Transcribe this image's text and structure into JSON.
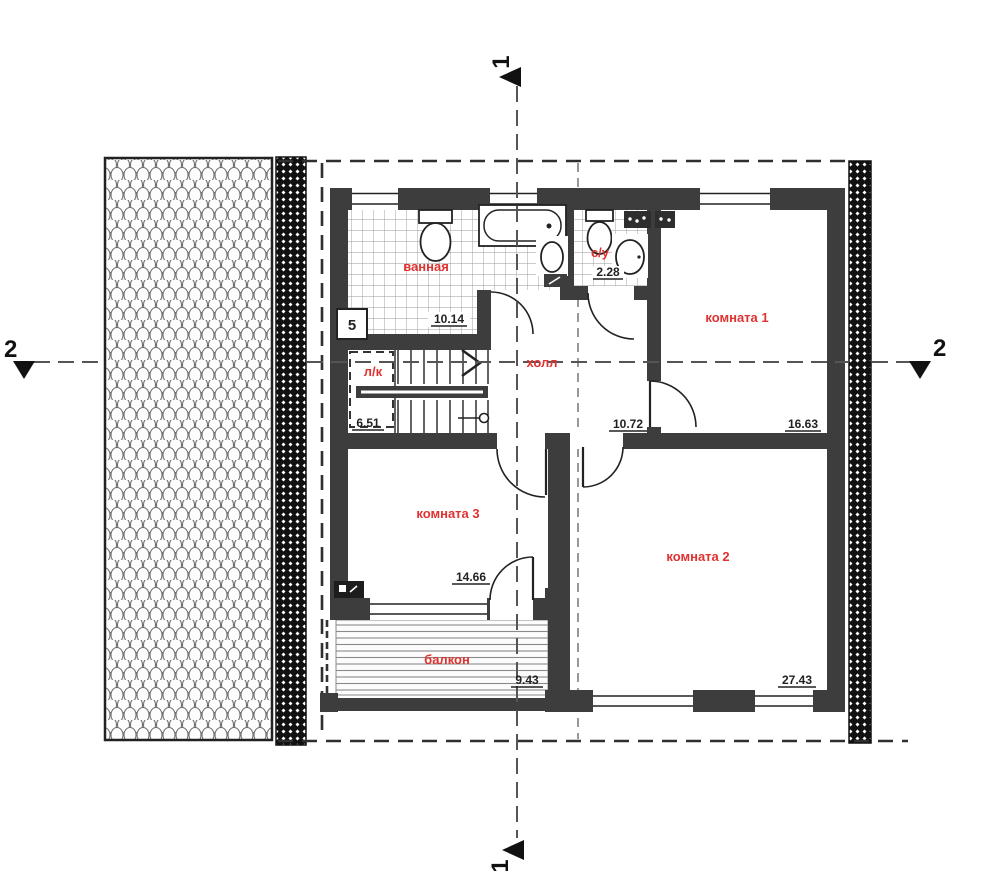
{
  "plan": {
    "title": "floor plan – second (attic) level",
    "rooms": {
      "bathroom": {
        "label": "ванная",
        "area": "10.14"
      },
      "wc": {
        "label": "с/у",
        "area": "2.28"
      },
      "room1": {
        "label": "комната 1",
        "area": "16.63"
      },
      "hall": {
        "label": "холл",
        "area": "10.72"
      },
      "stairs": {
        "label": "л/к",
        "area": "6.51"
      },
      "room3": {
        "label": "комната 3",
        "area": "14.66"
      },
      "room2": {
        "label": "комната 2",
        "area": "27.43"
      },
      "balcony": {
        "label": "балкон",
        "area": "9.43"
      }
    },
    "section_markers": {
      "longitudinal": "1",
      "transverse": "2"
    },
    "callouts": {
      "fixture_number": "5"
    },
    "colors": {
      "wall": "#3d3d3d",
      "room_label": "#e03231",
      "dimension_text": "#222222"
    }
  }
}
